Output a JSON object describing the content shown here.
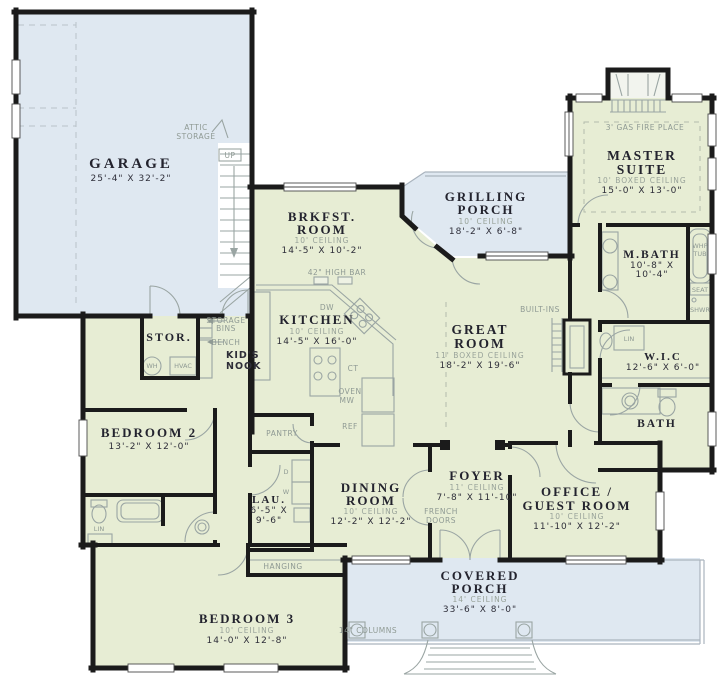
{
  "plan_colors": {
    "wall": "#1b1b1b",
    "room_fill": "#e7edd4",
    "porch_fill": "#dfe8f1",
    "fixture_line": "#9aa5a3",
    "label_dark": "#23232e",
    "label_muted": "#99a39a"
  },
  "rooms": {
    "garage": {
      "name": "GARAGE",
      "dims": "25'-4\" X 32'-2\""
    },
    "attic": {
      "line1": "ATTIC",
      "line2": "STORAGE"
    },
    "stairs": {
      "up": "UP"
    },
    "brkfst": {
      "name1": "BRKFST.",
      "name2": "ROOM",
      "ceiling": "10' CEILING",
      "dims": "14'-5\" X 10'-2\""
    },
    "grilling_porch": {
      "name1": "GRILLING",
      "name2": "PORCH",
      "ceiling": "10' CEILING",
      "dims": "18'-2\" X 6'-8\""
    },
    "master_suite": {
      "fireplace": "3' GAS FIRE PLACE",
      "name1": "MASTER",
      "name2": "SUITE",
      "ceiling": "10' BOXED CEILING",
      "dims": "15'-0\" X 13'-0\""
    },
    "mbath": {
      "name": "M.BATH",
      "dims1": "10'-8\" X",
      "dims2": "10'-4\"",
      "whp1": "WHP",
      "whp2": "TUB",
      "seat": "SEAT",
      "shwr": "SHWR",
      "lin": "LIN"
    },
    "wic": {
      "name": "W.I.C",
      "dims": "12'-6\" X 6'-0\""
    },
    "kitchen": {
      "name": "KITCHEN",
      "ceiling": "10' CEILING",
      "dims": "14'-5\" X 16'-0\"",
      "bar": "42\" HIGH BAR",
      "dw": "DW",
      "ct": "CT",
      "oven1": "OVEN",
      "oven2": "MW",
      "ref": "REF"
    },
    "great_room": {
      "name1": "GREAT",
      "name2": "ROOM",
      "ceiling": "11' BOXED CEILING",
      "dims": "18'-2\" X 19'-6\"",
      "builtins": "BUILT-INS"
    },
    "stor": {
      "name": "STOR.",
      "wh": "WH",
      "hvac": "HVAC"
    },
    "kids_nook": {
      "bins1": "STORAGE",
      "bins2": "BINS",
      "bench": "BENCH",
      "name1": "KID'S",
      "name2": "NOOK"
    },
    "bedroom2": {
      "name": "BEDROOM 2",
      "dims": "13'-2\" X 12'-0\"",
      "lin": "LIN"
    },
    "pantry": {
      "name": "PANTRY"
    },
    "laundry": {
      "name": "LAU.",
      "dims1": "6'-5\" X",
      "dims2": "9'-6\"",
      "d": "D",
      "w": "W",
      "hanging": "HANGING"
    },
    "dining": {
      "name1": "DINING",
      "name2": "ROOM",
      "ceiling": "10' CEILING",
      "dims": "12'-2\" X 12'-2\""
    },
    "foyer": {
      "name": "FOYER",
      "ceiling": "11' CEILING",
      "dims": "7'-8\" X 11'-10\"",
      "french1": "FRENCH",
      "french2": "DOORS"
    },
    "office": {
      "name1": "OFFICE /",
      "name2": "GUEST ROOM",
      "ceiling": "10' CEILING",
      "dims": "11'-10\" X 12'-2\""
    },
    "bath": {
      "name": "BATH"
    },
    "bedroom3": {
      "name": "BEDROOM 3",
      "ceiling": "10' CEILING",
      "dims": "14'-0\" X 12'-8\""
    },
    "covered_porch": {
      "name1": "COVERED",
      "name2": "PORCH",
      "ceiling": "14' CEILING",
      "dims": "33'-6\" X 8'-0\"",
      "columns": "14\" COLUMNS"
    }
  }
}
